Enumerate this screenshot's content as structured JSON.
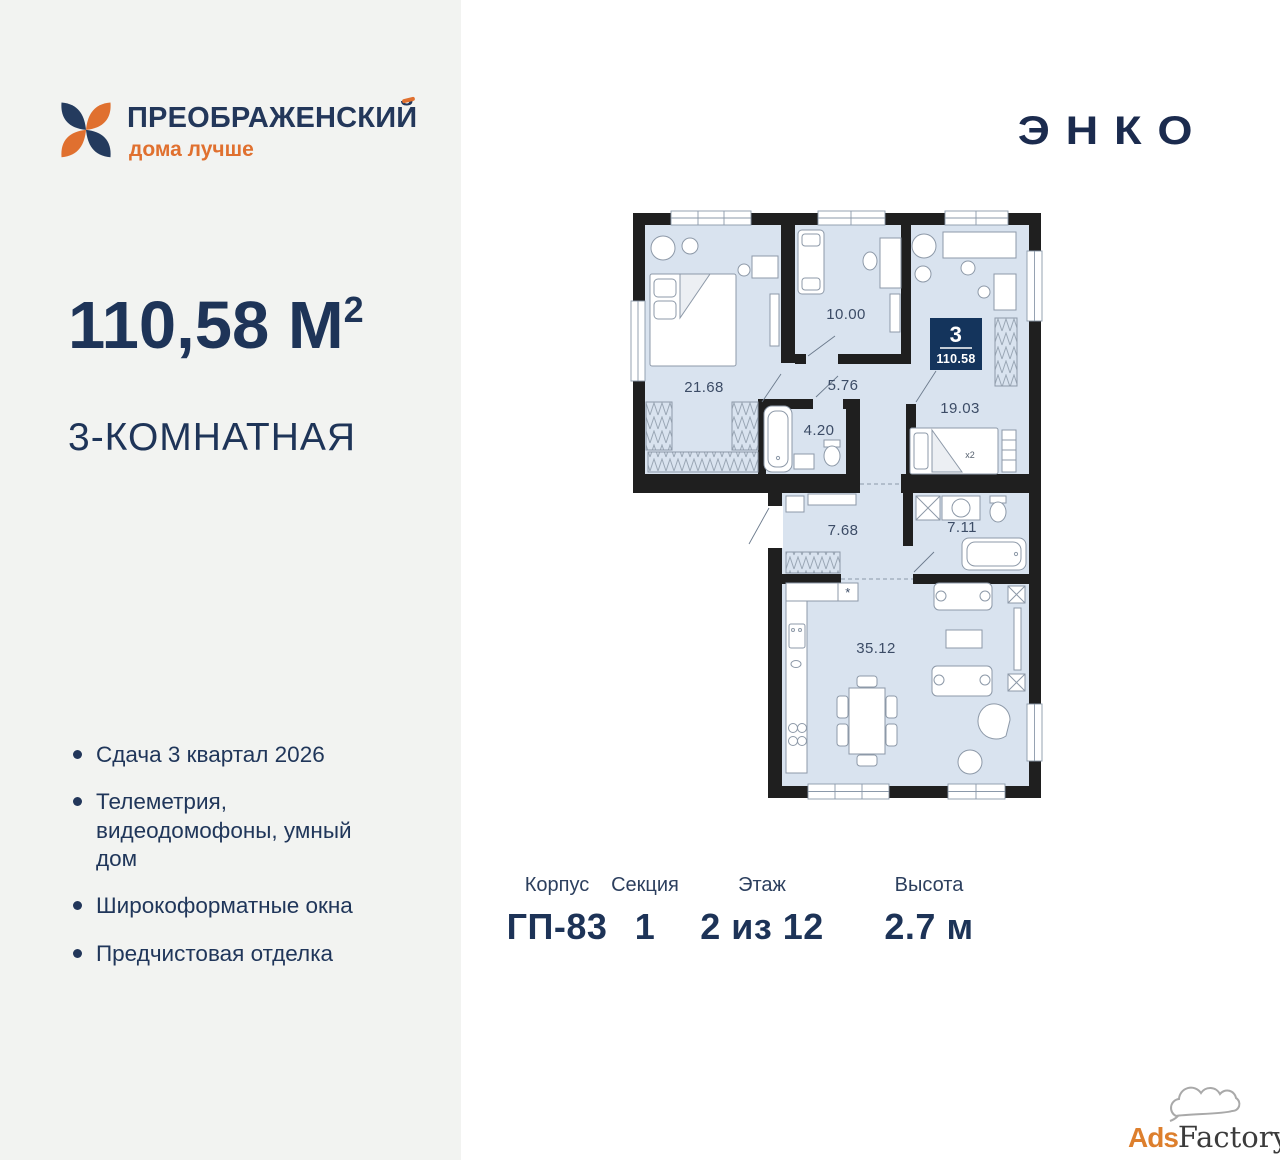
{
  "brand": {
    "name": "ПРЕОБРАЖЕНСКИЙ",
    "tagline": "дома лучше"
  },
  "developer": {
    "logo_text": "ЭНКО"
  },
  "listing": {
    "area_value": "110,58 М",
    "area_exp": "2",
    "type_label": "3-КОМНАТНАЯ"
  },
  "features": [
    "Сдача 3 квартал 2026",
    "Телеметрия, видеодомофоны, умный дом",
    "Широкоформатные окна",
    "Предчистовая отделка"
  ],
  "plan": {
    "badge": {
      "rooms": "3",
      "area": "110.58"
    },
    "rooms": {
      "bedroom1": "21.68",
      "room2": "10.00",
      "hall_top": "5.76",
      "bath_top": "4.20",
      "bedroom2": "19.03",
      "hall_bottom": "7.68",
      "bath_bottom": "7.11",
      "living": "35.12",
      "bed_note": "x2",
      "fridge_mark": "*"
    }
  },
  "specs": [
    {
      "label": "Корпус",
      "value": "ГП-83"
    },
    {
      "label": "Секция",
      "value": "1"
    },
    {
      "label": "Этаж",
      "value": "2 из 12"
    },
    {
      "label": "Высота",
      "value": "2.7 м"
    }
  ],
  "watermark": {
    "part1": "Ads",
    "part2": "Factory"
  },
  "colors": {
    "navy": "#1e3458",
    "orange": "#e0702f",
    "floor": "#d9e3ef",
    "wall": "#1f1f1f"
  }
}
